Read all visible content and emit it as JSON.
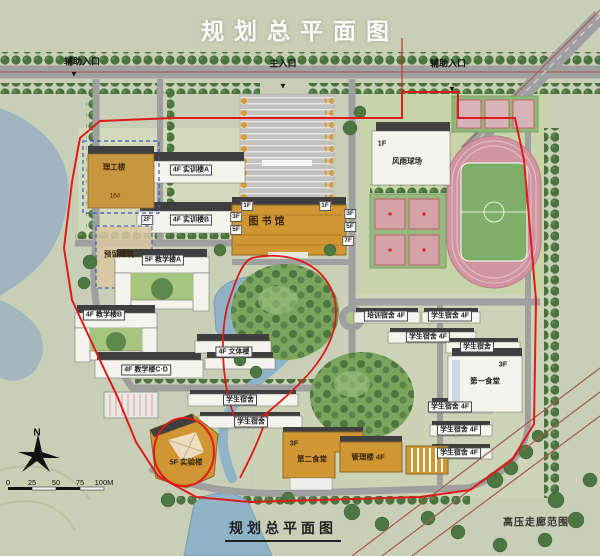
{
  "title": "规划总平面图",
  "caption": "规划总平面图",
  "compass": "N",
  "scalebar": {
    "ticks": [
      "0",
      "25",
      "50",
      "75",
      "100M"
    ]
  },
  "colors": {
    "boundary_red": "#e01a1a",
    "water": "#8fb3c6",
    "orange_building": "#cf9632",
    "track_pink": "#cf94a0",
    "field_green": "#7fae68",
    "road_gray": "#9f9f9f",
    "land": "#c9cfb6",
    "title_white": "#ffffff"
  },
  "labels": [
    {
      "name": "entrance-aux-west",
      "kind": "ent",
      "text": "辅助入口",
      "x": 82,
      "y": 61
    },
    {
      "name": "entrance-aux-west-arrow",
      "kind": "tri",
      "text": "▼",
      "x": 74,
      "y": 74
    },
    {
      "name": "entrance-main",
      "kind": "ent",
      "text": "主入口",
      "x": 283,
      "y": 63
    },
    {
      "name": "entrance-main-arrow",
      "kind": "tri",
      "text": "▼",
      "x": 283,
      "y": 86
    },
    {
      "name": "entrance-aux-east",
      "kind": "ent",
      "text": "辅助入口",
      "x": 448,
      "y": 63
    },
    {
      "name": "entrance-aux-east-arrow",
      "kind": "tri",
      "text": "▼",
      "x": 452,
      "y": 89
    },
    {
      "name": "building-label-ligonglou",
      "kind": "onbldg",
      "text": "理工楼",
      "x": 114,
      "y": 167
    },
    {
      "name": "building-label-ligonglou-area",
      "kind": "onbldg-sm",
      "text": "16#",
      "x": 115,
      "y": 196
    },
    {
      "name": "building-tag-yuliu-floors",
      "kind": "tag",
      "text": "2F",
      "x": 147,
      "y": 220
    },
    {
      "name": "building-label-yuliu",
      "kind": "onbldg",
      "text": "预留建筑",
      "x": 119,
      "y": 254
    },
    {
      "name": "building-label-shixun-a",
      "kind": "box",
      "text": "4F 实训楼A",
      "x": 191,
      "y": 170
    },
    {
      "name": "building-label-shixun-b",
      "kind": "box",
      "text": "4F 实训楼B",
      "x": 191,
      "y": 220
    },
    {
      "name": "building-tag-fengyu-floors",
      "kind": "plain",
      "text": "1F",
      "x": 382,
      "y": 143
    },
    {
      "name": "building-label-fengyu-qiuchang",
      "kind": "plain",
      "text": "风雨球场",
      "x": 407,
      "y": 161
    },
    {
      "name": "building-label-library",
      "kind": "lib",
      "text": "图书馆",
      "x": 268,
      "y": 220
    },
    {
      "name": "library-tag-1f-left",
      "kind": "tag",
      "text": "1F",
      "x": 247,
      "y": 206
    },
    {
      "name": "library-tag-1f-right",
      "kind": "tag",
      "text": "1F",
      "x": 325,
      "y": 206
    },
    {
      "name": "library-tag-3f-left",
      "kind": "tag",
      "text": "3F",
      "x": 236,
      "y": 217
    },
    {
      "name": "library-tag-5f-left",
      "kind": "tag",
      "text": "5F",
      "x": 236,
      "y": 230
    },
    {
      "name": "library-tag-3f-right",
      "kind": "tag",
      "text": "3F",
      "x": 350,
      "y": 214
    },
    {
      "name": "library-tag-5f-right",
      "kind": "tag",
      "text": "5F",
      "x": 350,
      "y": 227
    },
    {
      "name": "library-tag-7f-right",
      "kind": "tag",
      "text": "7F",
      "x": 348,
      "y": 241
    },
    {
      "name": "building-label-jiaoxue-a",
      "kind": "box",
      "text": "5F 教学楼A",
      "x": 163,
      "y": 260
    },
    {
      "name": "building-label-jiaoxue-b",
      "kind": "box",
      "text": "4F 教学楼B",
      "x": 104,
      "y": 315
    },
    {
      "name": "building-label-jiaoxue-cd",
      "kind": "box",
      "text": "4F 教学楼C·D",
      "x": 146,
      "y": 370
    },
    {
      "name": "building-label-wenti",
      "kind": "box",
      "text": "4F 文体楼",
      "x": 234,
      "y": 352
    },
    {
      "name": "building-label-peixun-dorm",
      "kind": "box",
      "text": "培训宿舍 4F",
      "x": 386,
      "y": 316
    },
    {
      "name": "building-label-dorm-1",
      "kind": "box",
      "text": "学生宿舍 4F",
      "x": 450,
      "y": 316
    },
    {
      "name": "building-label-dorm-2",
      "kind": "box",
      "text": "学生宿舍 4F",
      "x": 428,
      "y": 337
    },
    {
      "name": "building-label-dorm-3",
      "kind": "box",
      "text": "学生宿舍",
      "x": 477,
      "y": 347
    },
    {
      "name": "canteen1-floors-tag",
      "kind": "plain",
      "text": "3F",
      "x": 503,
      "y": 364
    },
    {
      "name": "building-label-canteen-1",
      "kind": "plain",
      "text": "第一食堂",
      "x": 485,
      "y": 381
    },
    {
      "name": "building-label-dorm-4",
      "kind": "box",
      "text": "学生宿舍 4F",
      "x": 450,
      "y": 407
    },
    {
      "name": "building-label-dorm-5",
      "kind": "box",
      "text": "学生宿舍 4F",
      "x": 459,
      "y": 430
    },
    {
      "name": "building-label-dorm-6",
      "kind": "box",
      "text": "学生宿舍 4F",
      "x": 459,
      "y": 453
    },
    {
      "name": "canteen2-floors-tag",
      "kind": "onbldg",
      "text": "3F",
      "x": 294,
      "y": 443
    },
    {
      "name": "building-label-canteen-2",
      "kind": "onbldg",
      "text": "第二食堂",
      "x": 312,
      "y": 459
    },
    {
      "name": "building-label-guanli",
      "kind": "onbldg",
      "text": "管理楼 4F",
      "x": 368,
      "y": 457
    },
    {
      "name": "building-label-shiyan",
      "kind": "onbldg",
      "text": "5F 实验楼",
      "x": 186,
      "y": 462
    },
    {
      "name": "building-label-dorm-7",
      "kind": "box",
      "text": "学生宿舍",
      "x": 240,
      "y": 400
    },
    {
      "name": "building-label-dorm-8",
      "kind": "box",
      "text": "学生宿舍",
      "x": 251,
      "y": 422
    },
    {
      "name": "hv-corridor-note",
      "kind": "hv",
      "text": "高压走廊范围",
      "x": 536,
      "y": 521
    },
    {
      "name": "compass-n-label",
      "kind": "north",
      "text": "N",
      "x": 37,
      "y": 433
    }
  ]
}
